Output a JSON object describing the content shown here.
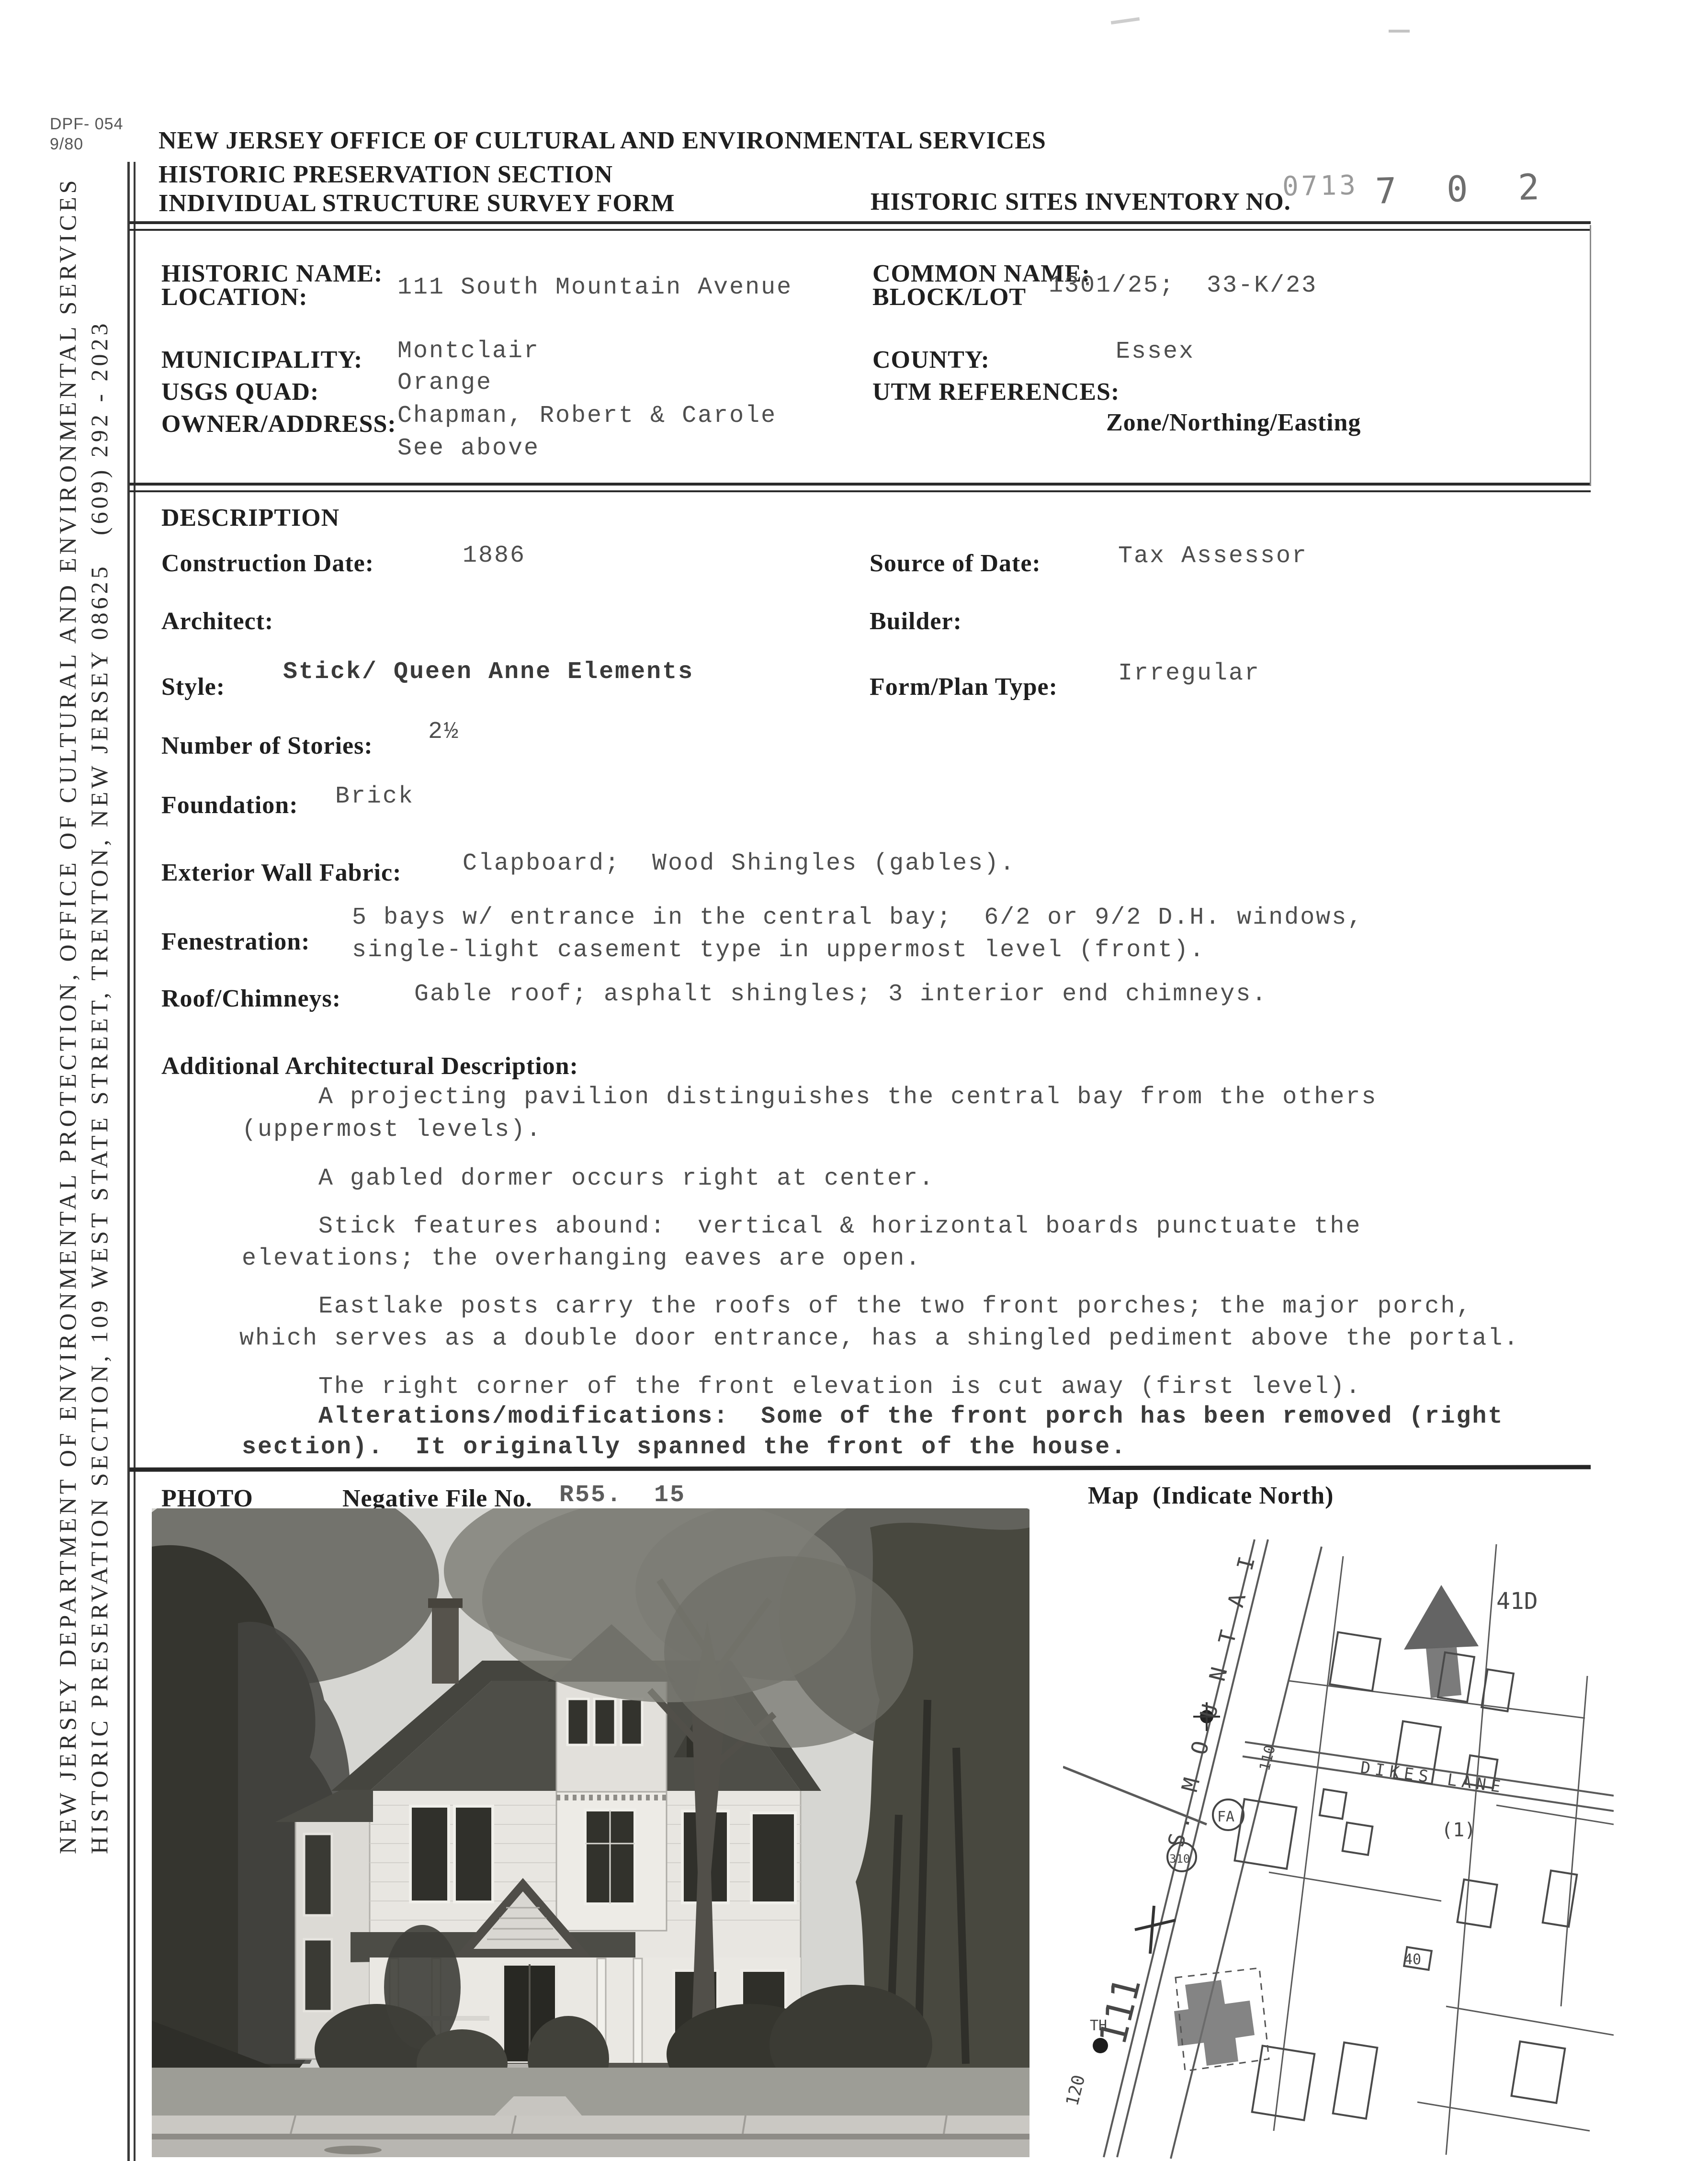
{
  "colors": {
    "paper": "#ffffff",
    "ink": "#1f1f1f",
    "typewriter": "#4e4e4e",
    "stamp_light": "#9a9a9a",
    "stamp_dark": "#6e6e6e",
    "rule": "#2b2b2b"
  },
  "form_meta": {
    "form_number": "DPF- 054",
    "form_date": "9/80"
  },
  "header": {
    "agency_line1": "NEW JERSEY OFFICE OF CULTURAL AND ENVIRONMENTAL SERVICES",
    "agency_line2": "HISTORIC PRESERVATION SECTION",
    "form_title": "INDIVIDUAL STRUCTURE SURVEY FORM",
    "inventory_label": "HISTORIC SITES INVENTORY NO.",
    "inventory_stamp_prefix": "0713",
    "inventory_stamp_number": "7 0 2"
  },
  "sidebar": {
    "line1": "NEW JERSEY DEPARTMENT OF ENVIRONMENTAL PROTECTION, OFFICE OF CULTURAL AND ENVIRONMENTAL SERVICES",
    "line2": "HISTORIC PRESERVATION SECTION, 109 WEST STATE STREET, TRENTON, NEW JERSEY 08625   (609) 292 - 2023"
  },
  "identification": {
    "historic_name_label": "HISTORIC NAME:",
    "location_label": "LOCATION:",
    "location_value": "111 South Mountain Avenue",
    "common_name_label": "COMMON NAME:",
    "block_lot_label": "BLOCK/LOT",
    "block_lot_value": "1301/25;  33-K/23",
    "municipality_label": "MUNICIPALITY:",
    "municipality_value": "Montclair",
    "county_label": "COUNTY:",
    "county_value": "Essex",
    "usgs_quad_label": "USGS QUAD:",
    "usgs_quad_value": "Orange",
    "utm_label": "UTM REFERENCES:",
    "utm_sub_label": "Zone/Northing/Easting",
    "owner_label": "OWNER/ADDRESS:",
    "owner_value_line1": "Chapman, Robert & Carole",
    "owner_value_line2": "See above"
  },
  "description": {
    "section_title": "DESCRIPTION",
    "construction_date_label": "Construction Date:",
    "construction_date_value": "1886",
    "source_of_date_label": "Source of Date:",
    "source_of_date_value": "Tax Assessor",
    "architect_label": "Architect:",
    "builder_label": "Builder:",
    "style_label": "Style:",
    "style_value": "Stick/ Queen Anne Elements",
    "form_plan_label": "Form/Plan Type:",
    "form_plan_value": "Irregular",
    "stories_label": "Number of Stories:",
    "stories_value": "2½",
    "foundation_label": "Foundation:",
    "foundation_value": "Brick",
    "wall_fabric_label": "Exterior Wall Fabric:",
    "wall_fabric_value": "Clapboard;  Wood Shingles (gables).",
    "fenestration_label": "Fenestration:",
    "fenestration_line1": "5 bays w/ entrance in the central bay;  6/2 or 9/2 D.H. windows,",
    "fenestration_line2": "single-light casement type in uppermost level (front).",
    "roof_label": "Roof/Chimneys:",
    "roof_value": "Gable roof; asphalt shingles; 3 interior end chimneys.",
    "additional_label": "Additional Architectural Description:",
    "paragraphs": [
      {
        "line1": "A projecting pavilion distinguishes the central bay from the others",
        "line2": "(uppermost levels)."
      },
      {
        "line1": "A gabled dormer occurs right at center.",
        "line2": ""
      },
      {
        "line1": "Stick features abound:  vertical & horizontal boards punctuate the",
        "line2": "elevations; the overhanging eaves are open."
      },
      {
        "line1": "Eastlake posts carry the roofs of the two front porches; the major porch,",
        "line2": "which serves as a double door entrance, has a shingled pediment above the portal."
      },
      {
        "line1": "The right corner of the front elevation is cut away (first level).",
        "line2": ""
      },
      {
        "line1": "Alterations/modifications:  Some of the front porch has been removed (right",
        "line2": "section).  It originally spanned the front of the house."
      }
    ]
  },
  "photo_section": {
    "photo_label": "PHOTO",
    "negative_label": "Negative File No.",
    "negative_value": "R55.  15",
    "map_label": "Map  (Indicate North)"
  },
  "map": {
    "road_label": "S. M O U N T A I N",
    "street_label": "DIKES  LANE",
    "labels": {
      "parcel": "41D",
      "lot_note": "(1)",
      "circle1": "FA",
      "circle2": "310",
      "box": "40",
      "house_number": "111",
      "house_number_alt": "110",
      "address": "120",
      "th": "TH"
    }
  }
}
